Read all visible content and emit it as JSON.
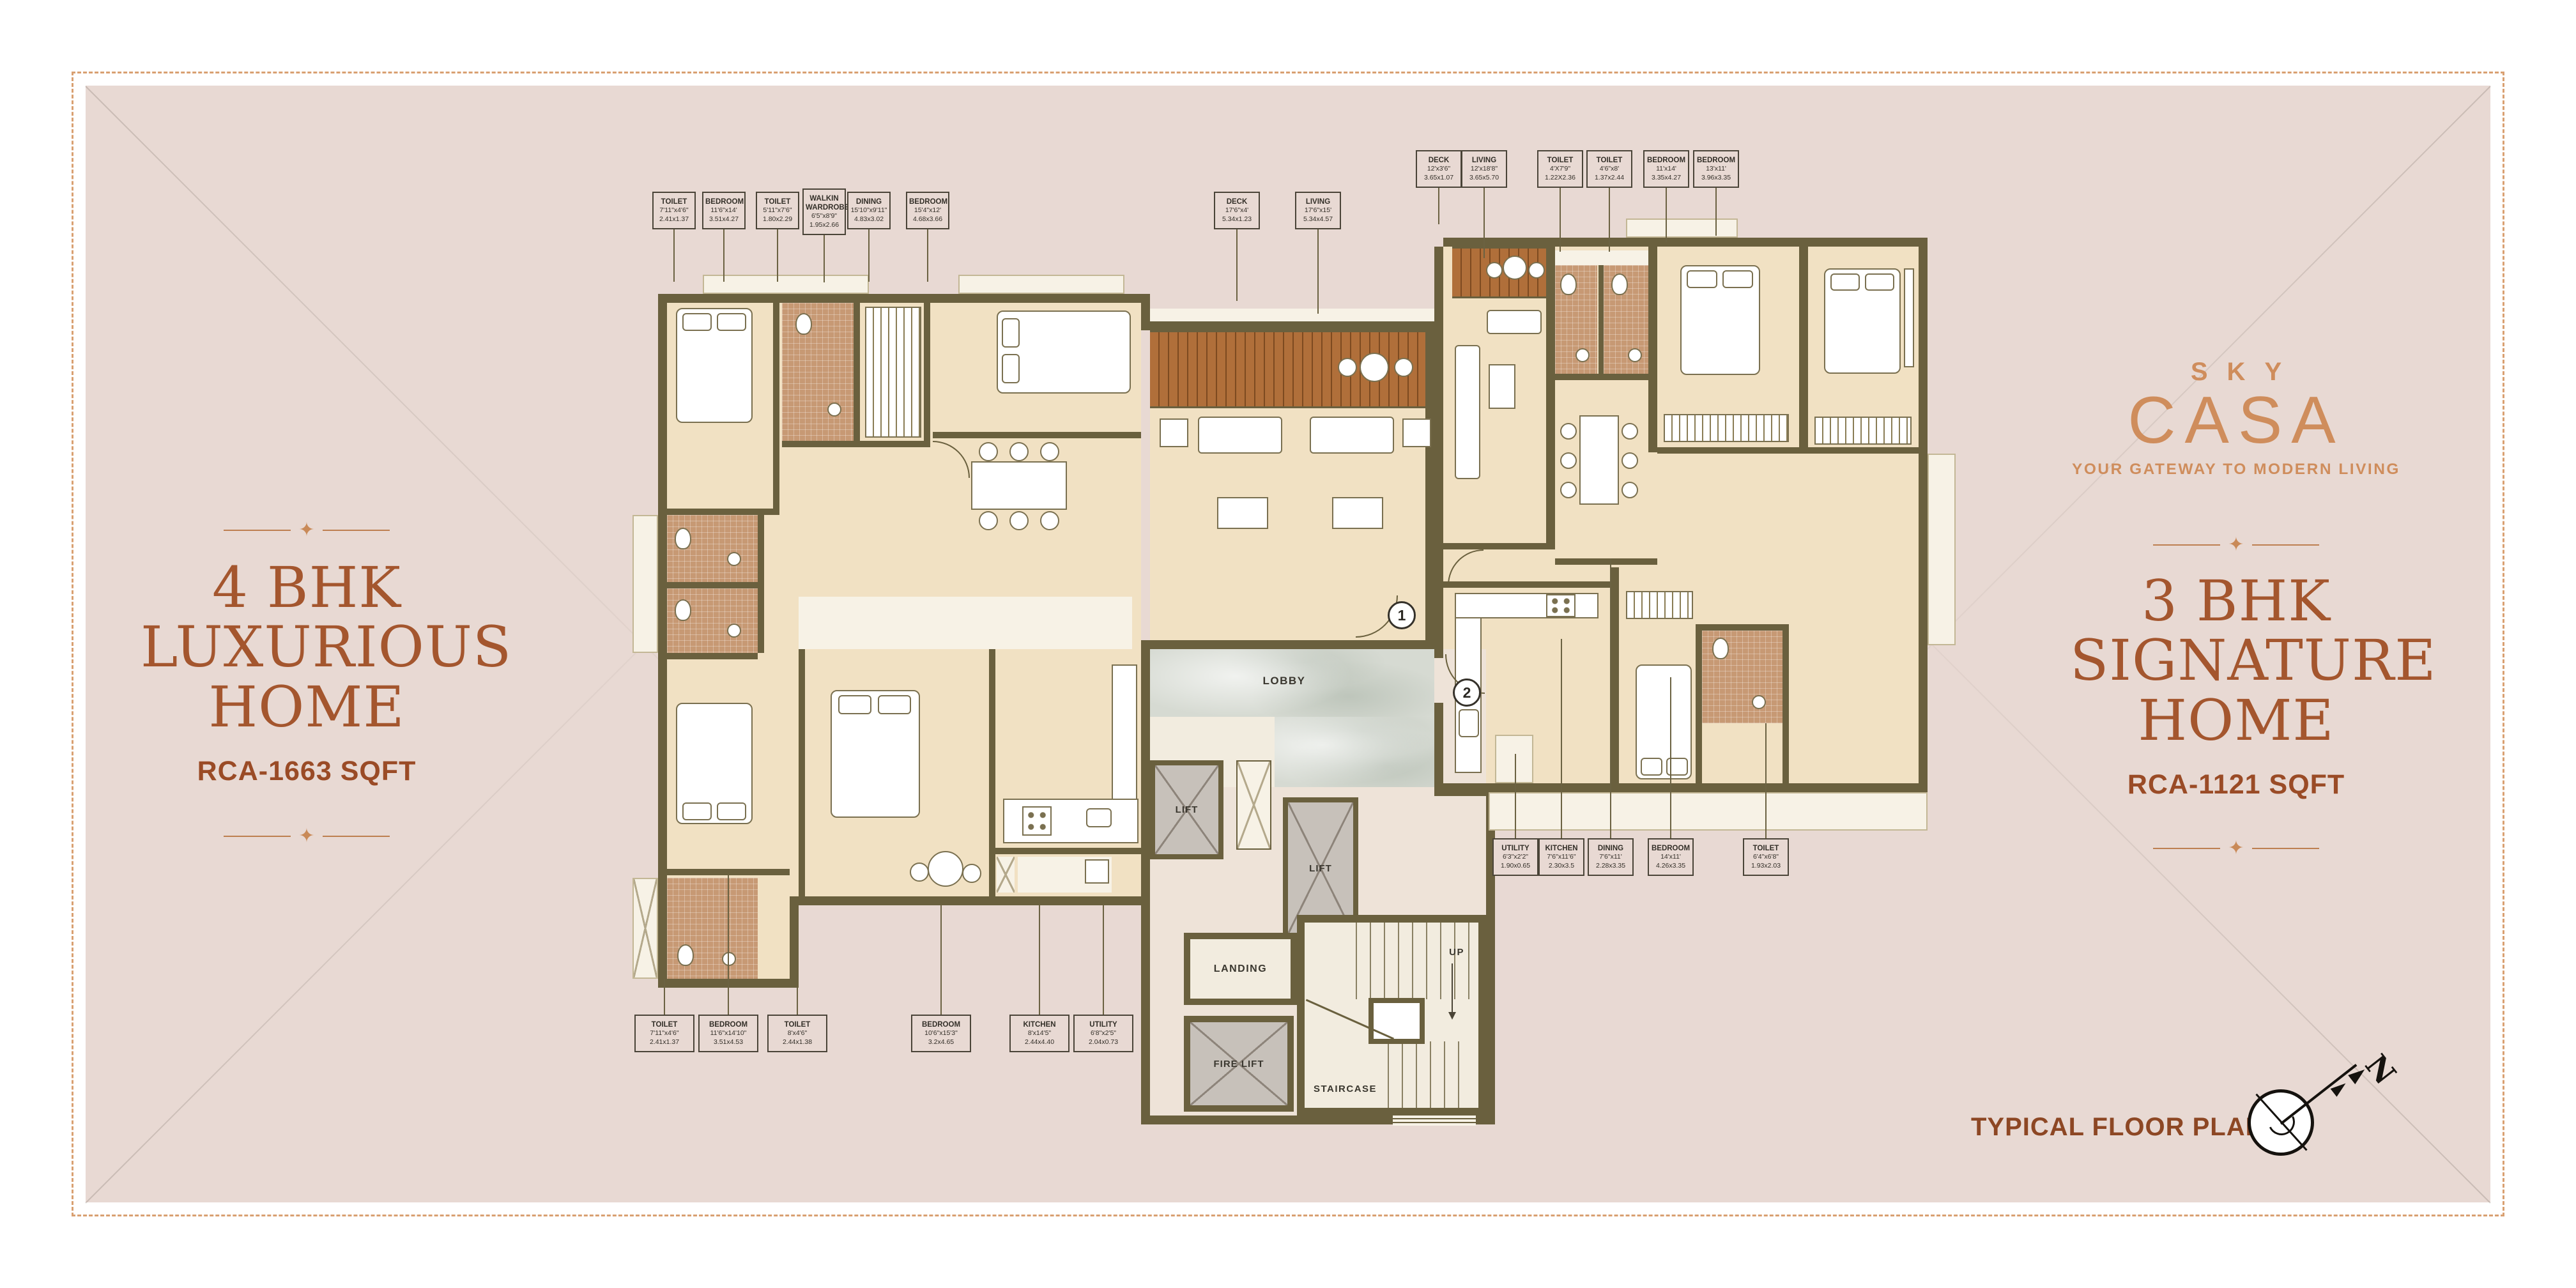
{
  "left_unit": {
    "title_line1": "4 BHK",
    "title_line2": "LUXURIOUS",
    "title_line3": "HOME",
    "area": "RCA-1663 SQFT"
  },
  "right_unit": {
    "title_line1": "3 BHK",
    "title_line2": "SIGNATURE",
    "title_line3": "HOME",
    "area": "RCA-1121 SQFT"
  },
  "brand": {
    "sky": "SKY",
    "casa": "CASA",
    "tagline": "YOUR GATEWAY TO MODERN LIVING",
    "star": "✦"
  },
  "footer": {
    "plan_label": "TYPICAL FLOOR PLAN",
    "compass_n": "N"
  },
  "core": {
    "lobby": "LOBBY",
    "lift_a": "LIFT",
    "lift_b": "LIFT",
    "landing": "LANDING",
    "up": "UP",
    "fire_lift": "FIRE LIFT",
    "staircase": "STAIRCASE",
    "marker_unit1": "1",
    "marker_unit2": "2"
  },
  "callouts": {
    "top_left": [
      {
        "name": "TOILET",
        "ft": "7'11\"x4'6\"",
        "m": "2.41x1.37"
      },
      {
        "name": "BEDROOM",
        "ft": "11'6\"x14'",
        "m": "3.51x4.27"
      },
      {
        "name": "TOILET",
        "ft": "5'11\"x7'6\"",
        "m": "1.80x2.29"
      },
      {
        "name": "WALKIN WARDROBE",
        "ft": "6'5\"x8'9\"",
        "m": "1.95x2.66"
      },
      {
        "name": "DINING",
        "ft": "15'10\"x9'11\"",
        "m": "4.83x3.02"
      },
      {
        "name": "BEDROOM",
        "ft": "15'4\"x12'",
        "m": "4.68x3.66"
      }
    ],
    "top_center": [
      {
        "name": "DECK",
        "ft": "17'6\"x4'",
        "m": "5.34x1.23"
      },
      {
        "name": "LIVING",
        "ft": "17'6\"x15'",
        "m": "5.34x4.57"
      }
    ],
    "top_right": [
      {
        "name": "DECK",
        "ft": "12'x3'6\"",
        "m": "3.65x1.07"
      },
      {
        "name": "LIVING",
        "ft": "12'x18'8\"",
        "m": "3.65x5.70"
      },
      {
        "name": "TOILET",
        "ft": "4'X7'9\"",
        "m": "1.22X2.36"
      },
      {
        "name": "TOILET",
        "ft": "4'6\"x8'",
        "m": "1.37x2.44"
      },
      {
        "name": "BEDROOM",
        "ft": "11'x14'",
        "m": "3.35x4.27"
      },
      {
        "name": "BEDROOM",
        "ft": "13'x11'",
        "m": "3.96x3.35"
      }
    ],
    "bottom_left": [
      {
        "name": "TOILET",
        "ft": "7'11\"x4'6\"",
        "m": "2.41x1.37"
      },
      {
        "name": "BEDROOM",
        "ft": "11'6\"x14'10\"",
        "m": "3.51x4.53"
      },
      {
        "name": "TOILET",
        "ft": "8'x4'6\"",
        "m": "2.44x1.38"
      },
      {
        "name": "BEDROOM",
        "ft": "10'6\"x15'3\"",
        "m": "3.2x4.65"
      },
      {
        "name": "KITCHEN",
        "ft": "8'x14'5\"",
        "m": "2.44x4.40"
      },
      {
        "name": "UTILITY",
        "ft": "6'8\"x2'5\"",
        "m": "2.04x0.73"
      }
    ],
    "bottom_right": [
      {
        "name": "UTILITY",
        "ft": "6'3\"x2'2\"",
        "m": "1.90x0.65"
      },
      {
        "name": "KITCHEN",
        "ft": "7'6\"x11'6\"",
        "m": "2.30x3.5"
      },
      {
        "name": "DINING",
        "ft": "7'6\"x11'",
        "m": "2.28x3.35"
      },
      {
        "name": "BEDROOM",
        "ft": "14'x11'",
        "m": "4.26x3.35"
      },
      {
        "name": "TOILET",
        "ft": "6'4\"x6'8\"",
        "m": "1.93x2.03"
      }
    ]
  },
  "colors": {
    "accent": "#a4562e",
    "logo": "#cf8d5c",
    "page": "#e8d9d3",
    "wall": "#6a603e",
    "floor": "#f1e1c3",
    "tile": "#c79974",
    "deck": "#b06f3a",
    "lobby_marble": "#d6dad2"
  }
}
